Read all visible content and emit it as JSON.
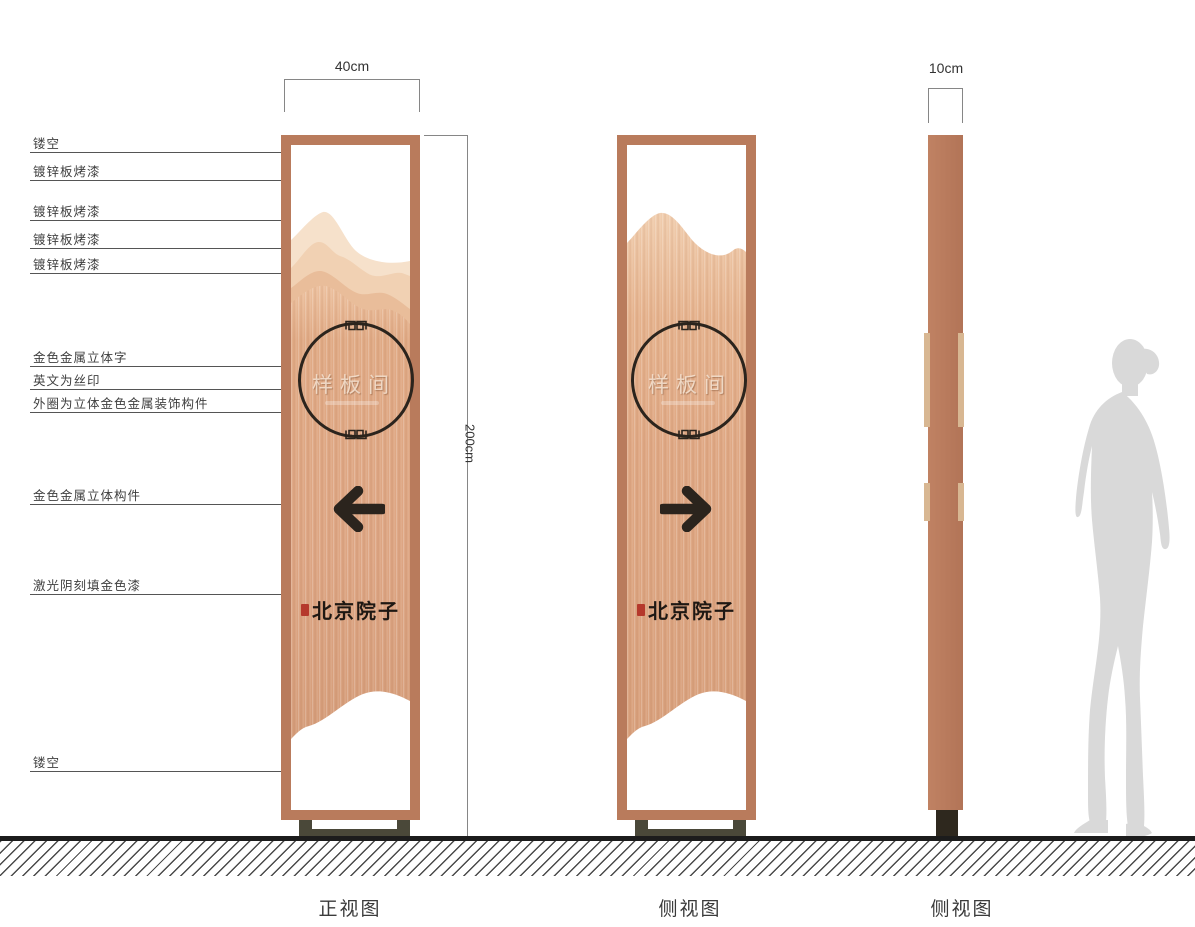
{
  "annotations": {
    "items": [
      {
        "label": "镂空"
      },
      {
        "label": "镀锌板烤漆"
      },
      {
        "label": "镀锌板烤漆"
      },
      {
        "label": "镀锌板烤漆"
      },
      {
        "label": "镀锌板烤漆"
      },
      {
        "label": "金色金属立体字"
      },
      {
        "label": "英文为丝印"
      },
      {
        "label": "外圈为立体金色金属装饰构件"
      },
      {
        "label": "金色金属立体构件"
      },
      {
        "label": "激光阴刻填金色漆"
      },
      {
        "label": "镂空"
      }
    ]
  },
  "dimensions": {
    "front_width": "40cm",
    "height": "200cm",
    "side_depth": "10cm"
  },
  "sign": {
    "room_name": "样板间",
    "brand_name": "北京院子"
  },
  "captions": {
    "front_view": "正视图",
    "side_view": "侧视图",
    "profile_view": "侧视图"
  },
  "colors": {
    "frame": "#b97b5c",
    "panel_copper": "#dda583",
    "dark_accent": "#2b241d",
    "seal_red": "#b5392c",
    "silhouette_gray": "#d9d9d9"
  }
}
